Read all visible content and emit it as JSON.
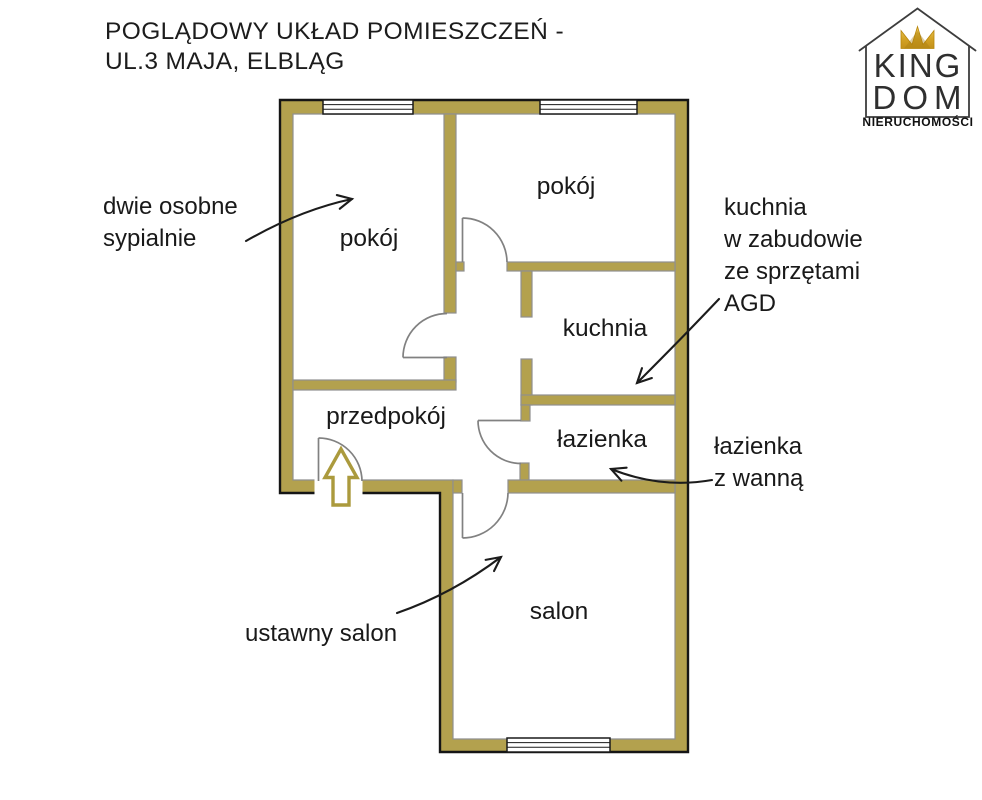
{
  "title": {
    "line1": "POGLĄDOWY UKŁAD POMIESZCZEŃ -",
    "line2": "UL.3 MAJA, ELBLĄG"
  },
  "logo": {
    "word1": "KING",
    "word2": "DOM",
    "subtitle": "NIERUCHOMOŚCI"
  },
  "rooms": {
    "pokoj_left": "pokój",
    "pokoj_right": "pokój",
    "kuchnia": "kuchnia",
    "przedpokoj": "przedpokój",
    "lazienka": "łazienka",
    "salon": "salon"
  },
  "annotations": {
    "bedrooms": {
      "lines": [
        "dwie osobne",
        "sypialnie"
      ]
    },
    "kitchen": {
      "lines": [
        "kuchnia",
        "w zabudowie",
        "ze sprzętami",
        "AGD"
      ]
    },
    "bathroom": {
      "lines": [
        "łazienka",
        "z wanną"
      ]
    },
    "living": {
      "lines": [
        "ustawny salon"
      ]
    }
  },
  "colors": {
    "wall_fill": "#b3a14e",
    "wall_inner_edge": "#8f8f8f",
    "outline": "#151515",
    "door_line": "#818181",
    "entrance_arrow": "#ab9a3d",
    "crown_gold": "#d4a326",
    "annotation_arrow": "#1c1c1c",
    "text": "#1a1a1a"
  }
}
